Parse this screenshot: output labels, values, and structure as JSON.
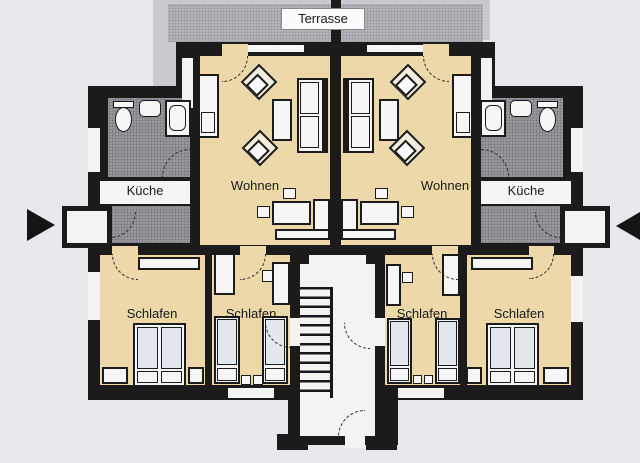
{
  "plan": {
    "title": "Terrasse",
    "labels": {
      "terrace": "Terrasse",
      "living": "Wohnen",
      "kitchen": "Küche",
      "bedroom": "Schlafen"
    },
    "rooms": [
      {
        "type": "terrace",
        "label": "Terrasse",
        "shared": true
      },
      {
        "type": "living",
        "label": "Wohnen",
        "apartment": "left"
      },
      {
        "type": "kitchen",
        "label": "Küche",
        "apartment": "left"
      },
      {
        "type": "bedroom",
        "label": "Schlafen",
        "apartment": "left",
        "count": 2
      },
      {
        "type": "living",
        "label": "Wohnen",
        "apartment": "right"
      },
      {
        "type": "kitchen",
        "label": "Küche",
        "apartment": "right"
      },
      {
        "type": "bedroom",
        "label": "Schlafen",
        "apartment": "right",
        "count": 2
      }
    ],
    "colors": {
      "wall": "#1b1b1b",
      "room_floor": "#ecd8a8",
      "wet_room": "#97979d",
      "terrace": "#b3b3b9",
      "background": "#e8e8ec",
      "hall_floor": "#f3f3f4"
    }
  }
}
